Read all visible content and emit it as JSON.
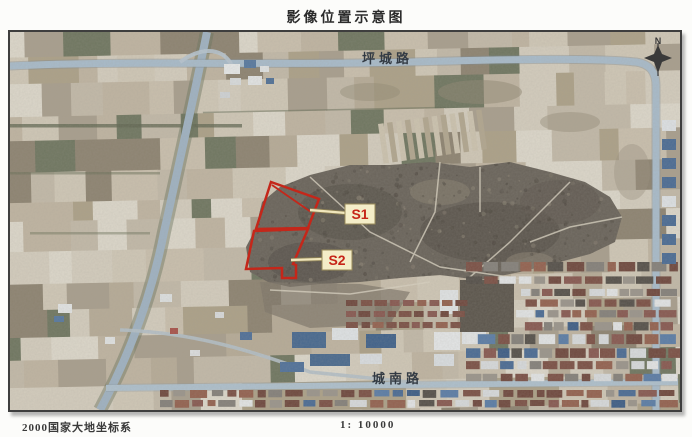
{
  "title": "影像位置示意图",
  "footer": {
    "coordinate_system": "2000国家大地坐标系",
    "scale": "1: 10000"
  },
  "map": {
    "north_label": "N",
    "roads": [
      {
        "name": "坪城路"
      },
      {
        "name": "城南路"
      }
    ],
    "colors": {
      "outline": "#c4271a",
      "label_bg": "#f4edc8",
      "label_border": "#9a8c5a",
      "label_text": "#c62417"
    },
    "sites": [
      {
        "label": "S1",
        "points": "261,150 309,167 298,196 246,197",
        "inner_line": "M262,153 L301,180",
        "leader": "M300,178 L336,181"
      },
      {
        "label": "S2",
        "points": "244,199 298,197 283,232 286,233 286,246 272,246 272,236 236,237",
        "inner_line": "",
        "leader": "M281,228 L313,227"
      }
    ]
  }
}
